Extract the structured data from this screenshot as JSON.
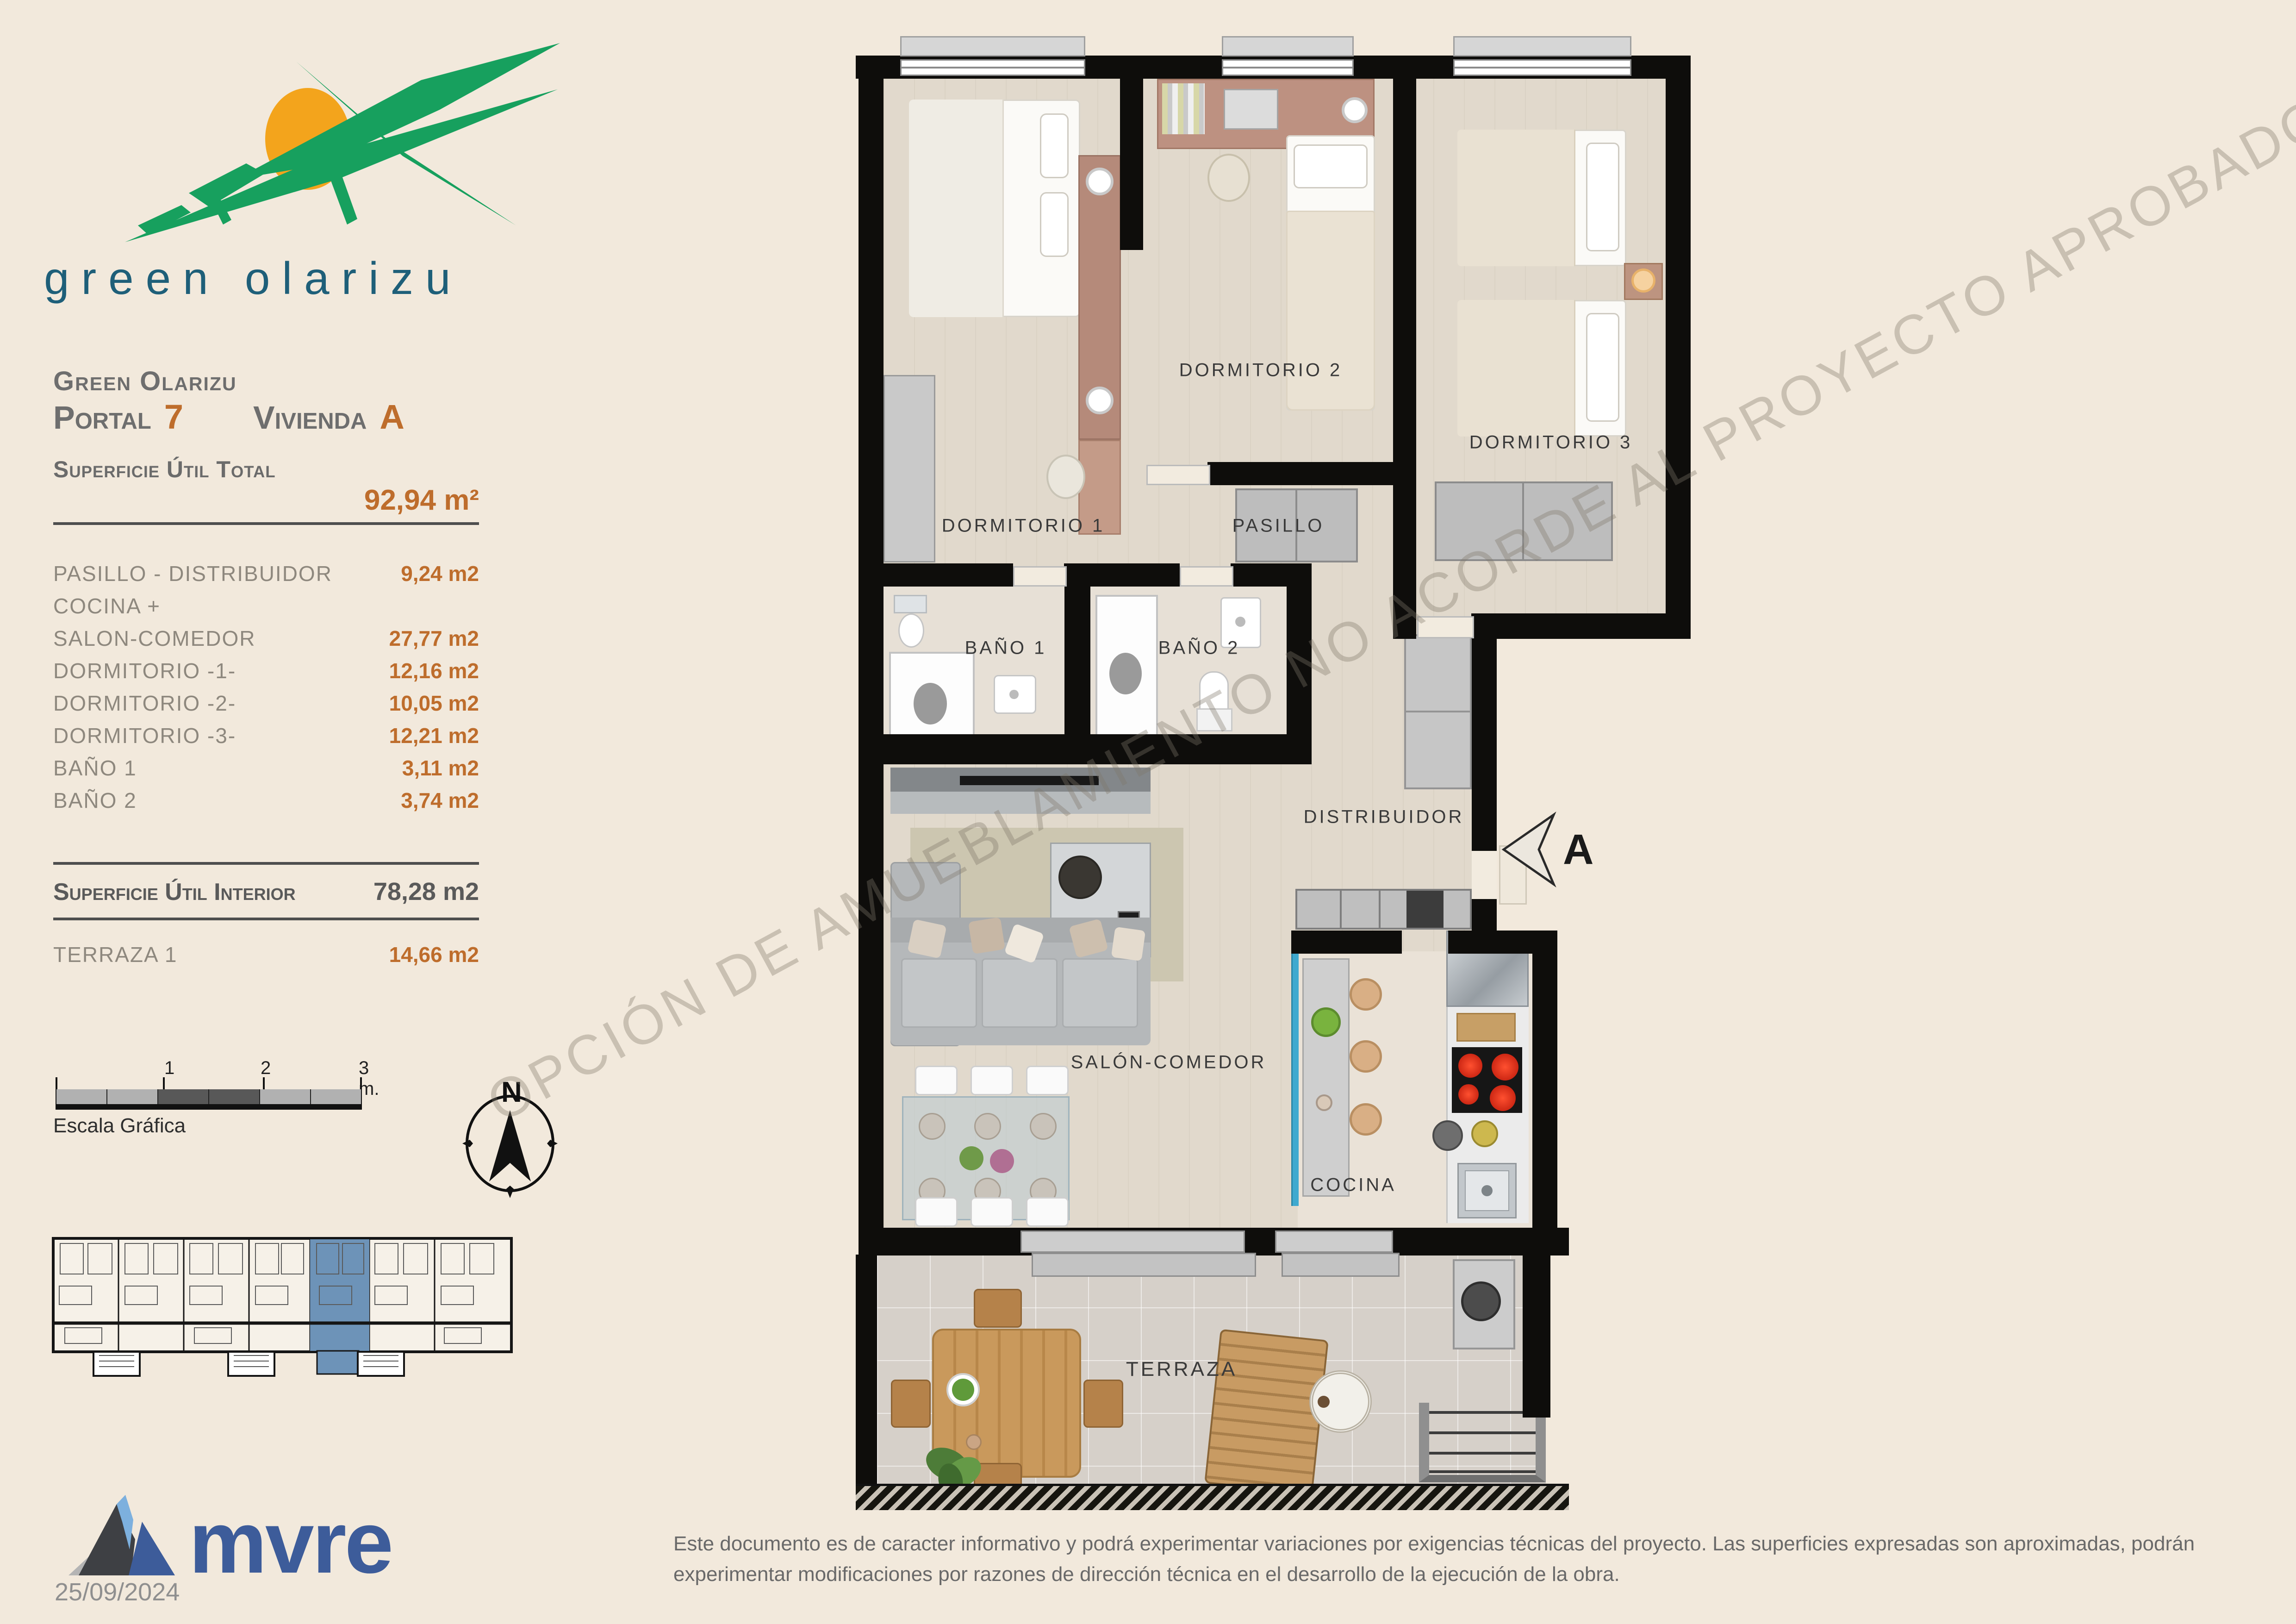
{
  "branding": {
    "logo_text": "green olarizu",
    "logo_green": "#17a05e",
    "logo_sun": "#f3a41c",
    "logo_text_color": "#1e5f79"
  },
  "header": {
    "project_name": "Green Olarizu",
    "portal_label": "Portal",
    "portal_number": "7",
    "vivienda_label": "Vivienda",
    "vivienda_letter": "A"
  },
  "surface": {
    "total_label": "Superficie Útil Total",
    "total_value": "92,94 m²",
    "rows": [
      {
        "label": "PASILLO - DISTRIBUIDOR",
        "value": "9,24 m2"
      },
      {
        "label": "COCINA +",
        "value": ""
      },
      {
        "label": "SALON-COMEDOR",
        "value": "27,77 m2"
      },
      {
        "label": "DORMITORIO -1-",
        "value": "12,16 m2"
      },
      {
        "label": "DORMITORIO -2-",
        "value": "10,05 m2"
      },
      {
        "label": "DORMITORIO -3-",
        "value": "12,21 m2"
      },
      {
        "label": "BAÑO 1",
        "value": "3,11 m2"
      },
      {
        "label": "BAÑO 2",
        "value": "3,74 m2"
      }
    ],
    "interior_label": "Superficie Útil Interior",
    "interior_value": "78,28 m2",
    "terrace_label": "TERRAZA 1",
    "terrace_value": "14,66 m2",
    "accent_color": "#be6d2c"
  },
  "scale_bar": {
    "label": "Escala Gráfica",
    "tick_1": "1",
    "tick_2": "2",
    "tick_3": "3 m."
  },
  "compass": {
    "north": "N"
  },
  "key_plan": {
    "highlight_color": "#6d93b8"
  },
  "plan": {
    "labels": {
      "dormitorio1": "DORMITORIO 1",
      "dormitorio2": "DORMITORIO 2",
      "dormitorio3": "DORMITORIO 3",
      "pasillo": "PASILLO",
      "bano1": "BAÑO 1",
      "bano2": "BAÑO 2",
      "distribuidor": "DISTRIBUIDOR",
      "salon": "SALÓN-COMEDOR",
      "cocina": "COCINA",
      "terraza": "TERRAZA"
    },
    "section_marker": "A",
    "watermark": "OPCIÓN DE AMUEBLAMIENTO NO ACORDE AL PROYECTO APROBADO"
  },
  "footer": {
    "company": "mvre",
    "brand_color": "#3d5c9a",
    "date": "25/09/2024",
    "disclaimer": "Este documento es de caracter informativo y podrá experimentar variaciones por exigencias técnicas del proyecto. Las superficies expresadas son aproximadas, podrán experimentar modificaciones por razones de dirección técnica en el desarrollo de la ejecución de la obra."
  }
}
